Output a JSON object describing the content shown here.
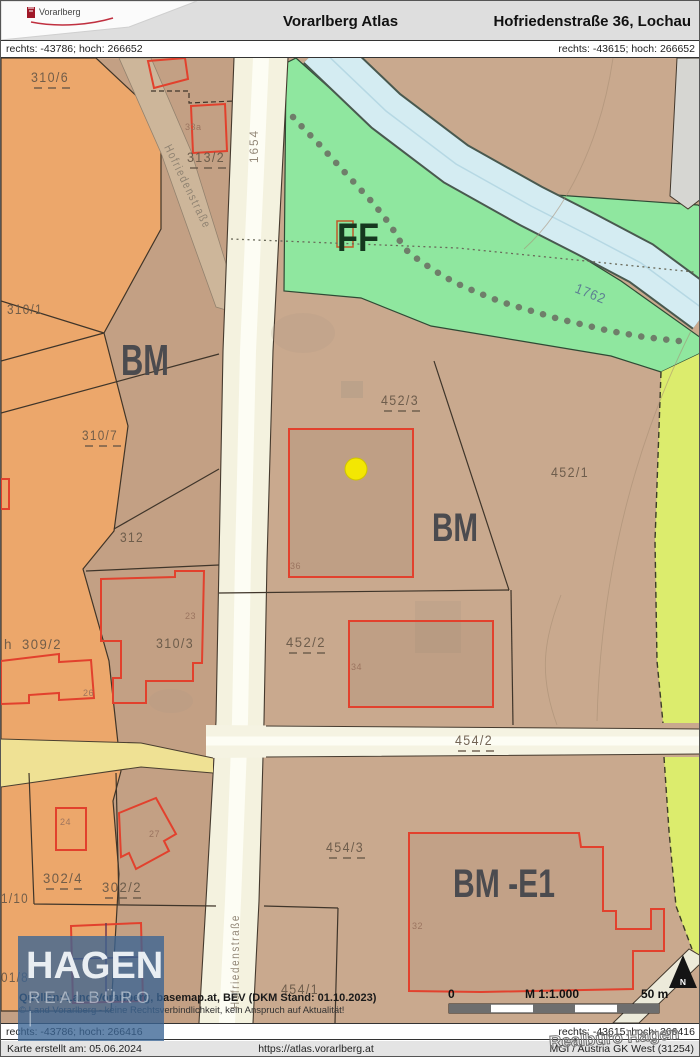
{
  "header": {
    "app_title": "Vorarlberg Atlas",
    "location_title": "Hofriedenstraße 36, Lochau",
    "logo_text": "Vorarlberg"
  },
  "coords": {
    "top_left": "rechts: -43786; hoch: 266652",
    "top_right": "rechts: -43615; hoch: 266652",
    "bottom_left": "rechts: -43786; hoch: 266416",
    "bottom_right": "rechts: -43615; hoch: 266416"
  },
  "footer": {
    "created": "Karte erstellt am: 05.06.2024",
    "url": "https://atlas.vorarlberg.at",
    "crs": "MGI / Austria GK West (31254)"
  },
  "watermark": "Realbüro Hagen",
  "hagen_logo": {
    "name": "HAGEN",
    "sub": "REALBÜRO |"
  },
  "map": {
    "source_line1": "Quellen: Land Vorarlberg, basemap.at, BEV (DKM Stand: 01.10.2023)",
    "source_line2": "© Land Vorarlberg - keine Rechtsverbindlichkeit, kein Anspruch auf Aktualität!",
    "scale": {
      "zero": "0",
      "ratio": "M 1:1.000",
      "max": "50 m"
    },
    "north_letter": "N",
    "colors": {
      "building_outline_red": "#e2412d",
      "zone_tan": "#c9a98e",
      "zone_orange": "#eca76b",
      "zone_green": "#8fe79f",
      "zone_lime": "#dcec6d",
      "water_blue": "#d4ecf2",
      "road_cream": "#f4f2df",
      "road_yellow": "#efe194",
      "marker_yellow": "#f3e703",
      "logo_blue": "#3a6494"
    },
    "labels": [
      {
        "t": "FF",
        "x": 336,
        "y": 250,
        "s": 40,
        "l": 42,
        "k": "zoneg"
      },
      {
        "t": "BM",
        "x": 120,
        "y": 374,
        "s": 44,
        "l": 48,
        "k": "zone"
      },
      {
        "t": "BM",
        "x": 431,
        "y": 540,
        "s": 40,
        "l": 46,
        "k": "zone"
      },
      {
        "t": "BM -E1",
        "x": 452,
        "y": 896,
        "s": 40,
        "l": 102,
        "k": "zone"
      },
      {
        "t": "310/6",
        "x": 30,
        "y": 81,
        "l": 38,
        "k": "parcel",
        "dash": 40
      },
      {
        "t": "313/2",
        "x": 186,
        "y": 161,
        "l": 38,
        "k": "parcel",
        "dash": 42
      },
      {
        "t": "310/1",
        "x": 6,
        "y": 313,
        "l": 36,
        "k": "parcel"
      },
      {
        "t": "310/7",
        "x": 81,
        "y": 439,
        "l": 36,
        "k": "parcel",
        "dash": 40
      },
      {
        "t": "312",
        "x": 119,
        "y": 541,
        "l": 24,
        "k": "parcel"
      },
      {
        "t": "h",
        "x": 3,
        "y": 648,
        "k": "parcel"
      },
      {
        "t": "309/2",
        "x": 21,
        "y": 648,
        "l": 40,
        "k": "parcel"
      },
      {
        "t": "310/3",
        "x": 155,
        "y": 647,
        "l": 38,
        "k": "parcel"
      },
      {
        "t": "452/3",
        "x": 380,
        "y": 404,
        "l": 38,
        "k": "parcel",
        "dash": 42
      },
      {
        "t": "452/1",
        "x": 550,
        "y": 476,
        "l": 38,
        "k": "parcel"
      },
      {
        "t": "452/2",
        "x": 285,
        "y": 646,
        "l": 40,
        "k": "parcel",
        "dash": 42
      },
      {
        "t": "454/2",
        "x": 454,
        "y": 744,
        "l": 38,
        "k": "parcel",
        "dash": 42
      },
      {
        "t": "454/3",
        "x": 325,
        "y": 851,
        "l": 38,
        "k": "parcel",
        "dash": 40
      },
      {
        "t": "454/1",
        "x": 280,
        "y": 993,
        "l": 38,
        "k": "parcel"
      },
      {
        "t": "302/4",
        "x": 42,
        "y": 882,
        "l": 40,
        "k": "parcel",
        "dash": 40
      },
      {
        "t": "302/2",
        "x": 101,
        "y": 891,
        "l": 40,
        "k": "parcel",
        "dash": 40
      },
      {
        "t": "1/10",
        "x": 0,
        "y": 902,
        "l": 28,
        "k": "parcel"
      },
      {
        "t": "01/8",
        "x": 0,
        "y": 981,
        "l": 28,
        "k": "parcel"
      },
      {
        "t": "1654",
        "x": 257,
        "y": 162,
        "s": 13,
        "l": 34,
        "k": "road",
        "r": -90
      },
      {
        "t": "Hofriedenstraße",
        "x": 163,
        "y": 146,
        "s": 12,
        "l": 92,
        "k": "road",
        "r": 64
      },
      {
        "t": "Hofriedenstraße",
        "x": 238,
        "y": 1008,
        "s": 12,
        "l": 95,
        "k": "road",
        "r": -90
      },
      {
        "t": "1762",
        "x": 573,
        "y": 291,
        "s": 14,
        "l": 32,
        "k": "water",
        "r": 22
      },
      {
        "t": "33a",
        "x": 184,
        "y": 129,
        "k": "bldg"
      },
      {
        "t": "36",
        "x": 289,
        "y": 568,
        "k": "bldg"
      },
      {
        "t": "34",
        "x": 350,
        "y": 669,
        "k": "bldg"
      },
      {
        "t": "23",
        "x": 184,
        "y": 618,
        "k": "bldg"
      },
      {
        "t": "26",
        "x": 82,
        "y": 695,
        "k": "bldg"
      },
      {
        "t": "24",
        "x": 59,
        "y": 824,
        "k": "bldg"
      },
      {
        "t": "27",
        "x": 148,
        "y": 836,
        "k": "bldg"
      },
      {
        "t": "32",
        "x": 411,
        "y": 928,
        "k": "bldg"
      }
    ]
  }
}
